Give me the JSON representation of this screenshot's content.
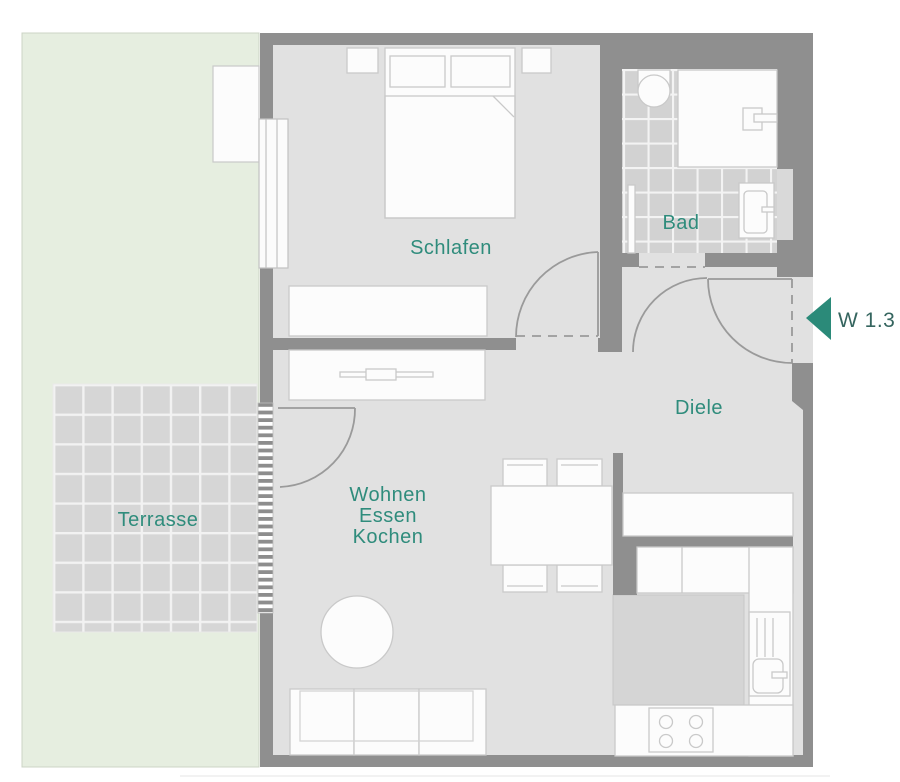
{
  "floorplan": {
    "unit_marker": {
      "label": "W 1.3",
      "arrow_direction": "left"
    },
    "rooms": {
      "schlafen": {
        "label": "Schlafen"
      },
      "bad": {
        "label": "Bad"
      },
      "diele": {
        "label": "Diele"
      },
      "wohnen": {
        "lines": [
          "Wohnen",
          "Essen",
          "Kochen"
        ]
      },
      "terrasse": {
        "label": "Terrasse"
      }
    },
    "colors": {
      "accent_teal": "#2f8c7c",
      "unit_label": "#35655f",
      "entrance_arrow": "#2b8a79",
      "wall": "#8f8f8f",
      "floor": "#e1e1e1",
      "bath_tile": "#d2d2d2",
      "terrace_tile": "#d6d6d6",
      "garden": "#e6eee0",
      "furniture_fill": "#fcfcfc",
      "furniture_stroke": "#c9c9c9",
      "door_line": "#9a9a9a",
      "kitchen_island": "#d5d5d5"
    }
  }
}
